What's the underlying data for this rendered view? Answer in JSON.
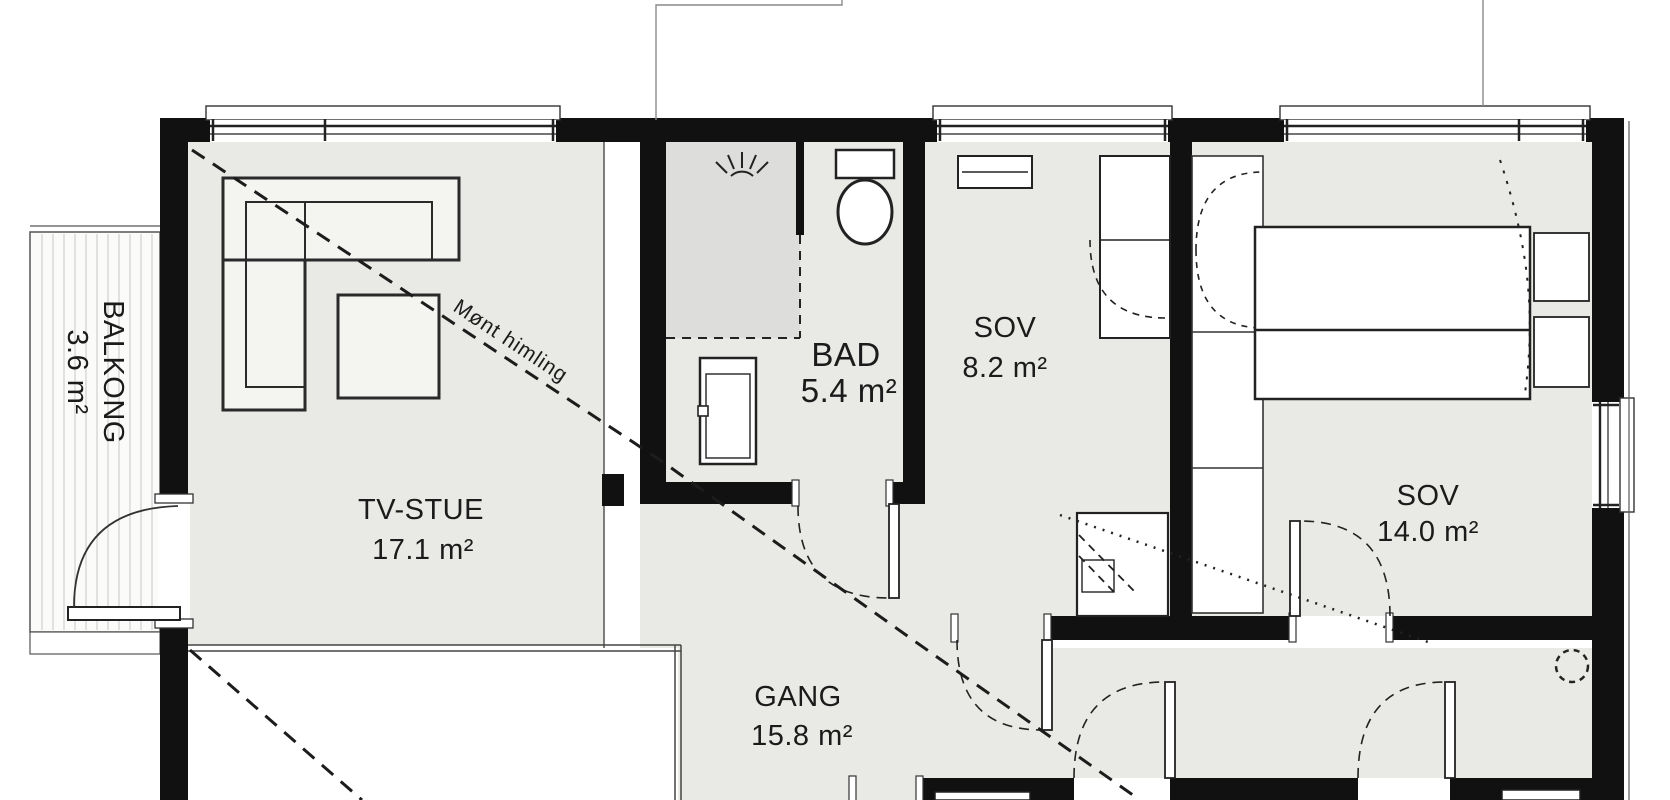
{
  "plan": {
    "title": "floor-plan",
    "rooms": [
      {
        "id": "balkong",
        "name": "BALKONG",
        "area": "3.6 m²"
      },
      {
        "id": "tvstue",
        "name": "TV-STUE",
        "area": "17.1 m²"
      },
      {
        "id": "bad",
        "name": "BAD",
        "area": "5.4 m²"
      },
      {
        "id": "sov1",
        "name": "SOV",
        "area": "8.2 m²"
      },
      {
        "id": "sov2",
        "name": "SOV",
        "area": "14.0 m²"
      },
      {
        "id": "gang",
        "name": "GANG",
        "area": "15.8 m²"
      }
    ],
    "annotations": [
      {
        "id": "ridge",
        "text": "Mønt himling"
      }
    ],
    "colors": {
      "wall": "#111111",
      "floor": "#e9e9e5",
      "floor_dark": "#dddddb",
      "white": "#ffffff",
      "line": "#333333"
    }
  }
}
